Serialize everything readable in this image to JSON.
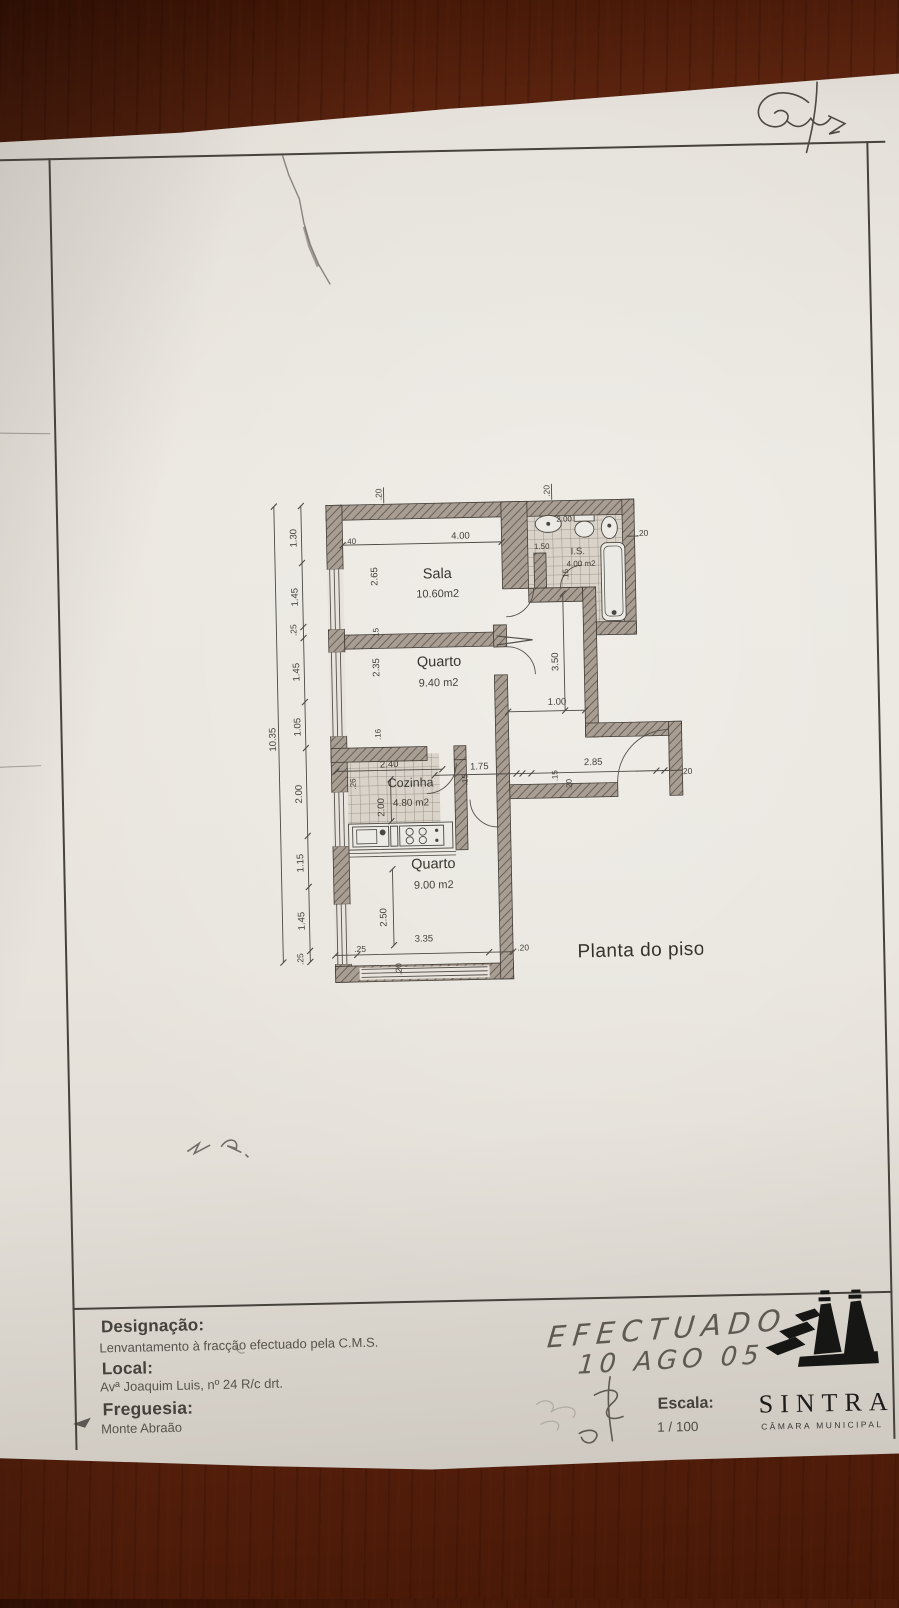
{
  "scene": {
    "wood_color": "#6e2f16",
    "paper_color": "#e8e4dd"
  },
  "plan": {
    "title": "Planta do piso",
    "rooms": {
      "sala": {
        "name": "Sala",
        "area": "10.60m2"
      },
      "quarto1": {
        "name": "Quarto",
        "area": "9.40 m2"
      },
      "cozinha": {
        "name": "Cozinha",
        "area": "4.80 m2"
      },
      "quarto2": {
        "name": "Quarto",
        "area": "9.00 m2"
      },
      "is": {
        "name": "I.S.",
        "area": "4.00 m2"
      }
    },
    "dim_labels": [
      "1.30",
      "1.45",
      ".25",
      "1.45",
      "1.05",
      "2.00",
      "1.15",
      "1.45",
      ".25",
      "10.35",
      ".20",
      "4.00",
      ".40",
      ".20",
      "2.00",
      ".20",
      "1.50",
      ".15",
      "2.65",
      ".15",
      "2.35",
      ".16",
      "3.50",
      "1.00",
      "2.40",
      ".26",
      "2.00",
      ".15",
      "1.75",
      ".15",
      ".20",
      "2.85",
      ".20",
      "2.50",
      "3.35",
      ".25",
      ".20",
      ".20"
    ]
  },
  "title_block": {
    "designacao_label": "Designação:",
    "designacao_value": "Lenvantamento à fracção efectuado pela C.M.S.",
    "local_label": "Local:",
    "local_value": "Avª Joaquim Luis, nº 24 R/c drt.",
    "freguesia_label": "Freguesia:",
    "freguesia_value": "Monte Abraão",
    "escala_label": "Escala:",
    "escala_value": "1 / 100",
    "logo_text": "SINTRA",
    "logo_subtext": "CÂMARA MUNICIPAL"
  },
  "annotations": {
    "note_line1": "EFECTUADO",
    "note_line2": "10 AGO 05"
  }
}
